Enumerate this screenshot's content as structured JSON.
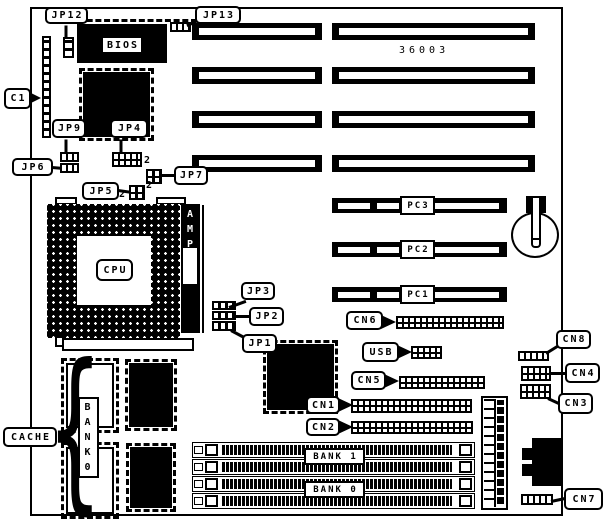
{
  "board": {
    "part_number": "36003"
  },
  "chips": {
    "bios": "BIOS",
    "cpu": "CPU",
    "amp": "AMP"
  },
  "jumpers": {
    "jp1": "JP1",
    "jp2": "JP2",
    "jp3": "JP3",
    "jp4": "JP4",
    "jp5": "JP5",
    "jp6": "JP6",
    "jp7": "JP7",
    "jp9": "JP9",
    "jp12": "JP12",
    "jp13": "JP13",
    "jp4_pin2": "2",
    "jp5_pin2": "2",
    "jp7_pin2": "2"
  },
  "connectors": {
    "c1": "C1",
    "cn1": "CN1",
    "cn2": "CN2",
    "cn3": "CN3",
    "cn4": "CN4",
    "cn5": "CN5",
    "cn6": "CN6",
    "cn7": "CN7",
    "cn8": "CN8",
    "usb": "USB"
  },
  "slots": {
    "pc1": "PC1",
    "pc2": "PC2",
    "pc3": "PC3"
  },
  "memory": {
    "bank1_label": "BANK 1",
    "bank0_label": "BANK 0",
    "cache_label": "CACHE",
    "cache_bank_label": "BANK0"
  }
}
